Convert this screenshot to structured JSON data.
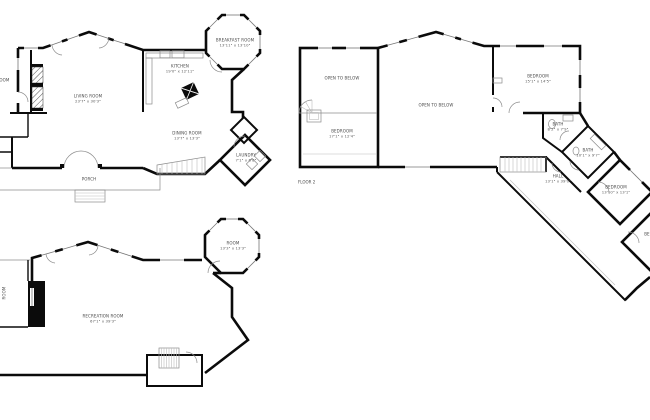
{
  "page": {
    "background": "#ffffff",
    "wall_color": "#0b0b0b",
    "label_color": "#4a4a4a"
  },
  "plans": [
    {
      "id": "floor-1",
      "rooms": [
        {
          "name": "LIVING ROOM",
          "dims": "23'7\" x 30'3\""
        },
        {
          "name": "KITCHEN",
          "dims": "19'0\" x 12'11\""
        },
        {
          "name": "BREAKFAST ROOM",
          "dims": "13'11\" x 13'10\""
        },
        {
          "name": "DINING ROOM",
          "dims": "13'7\" x 13'3\""
        },
        {
          "name": "LAUNDRY",
          "dims": "7'1\" x 6'8\""
        },
        {
          "name": "PORCH",
          "dims": ""
        },
        {
          "name": "ROOM",
          "dims": ""
        }
      ]
    },
    {
      "id": "floor-2",
      "floor_label": "FLOOR 2",
      "rooms": [
        {
          "name": "OPEN TO BELOW",
          "dims": ""
        },
        {
          "name": "BEDROOM",
          "dims": "17'1\" x 12'4\""
        },
        {
          "name": "OPEN TO BELOW",
          "dims": ""
        },
        {
          "name": "BEDROOM",
          "dims": "15'1\" x 14'5\""
        },
        {
          "name": "BATH",
          "dims": "8'2\" x 7'9\""
        },
        {
          "name": "BATH",
          "dims": "10'1\" x 9'7\""
        },
        {
          "name": "HALL",
          "dims": "13'1\" x 39'0\""
        },
        {
          "name": "BEDROOM",
          "dims": "13'10\" x 13'1\""
        },
        {
          "name": "BEDROOM",
          "dims": "11'1\""
        }
      ]
    },
    {
      "id": "lower-level",
      "rooms": [
        {
          "name": "RECREATION ROOM",
          "dims": "67'1\" x 39'3\""
        },
        {
          "name": "ROOM",
          "dims": "13'3\" x 13'3\""
        },
        {
          "name": "ROOM",
          "dims": ""
        }
      ]
    }
  ]
}
